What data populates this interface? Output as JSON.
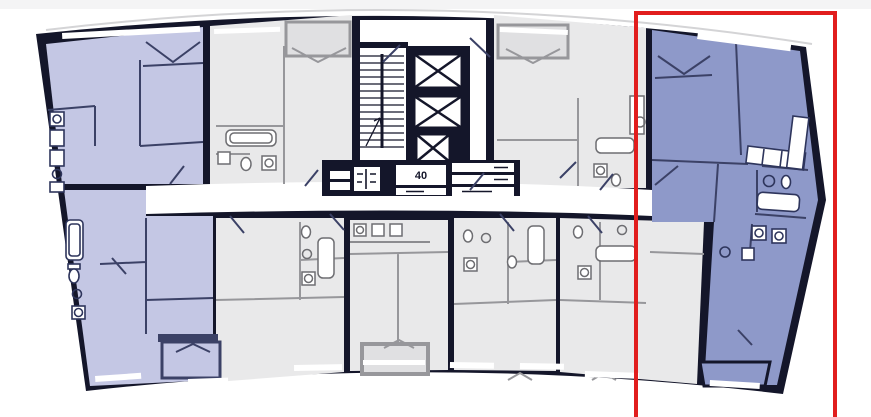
{
  "window": {
    "width": 871,
    "height": 417
  },
  "colors": {
    "background": "#ffffff",
    "top_band": "#f4f4f5",
    "wall": "#14162a",
    "apartment_lavender": "#c4c7e4",
    "apartment_periwinkle": "#8e99c9",
    "apartment_gray": "#e9e9ea",
    "loggia_gray": "#e0e0e2",
    "corridor_white": "#ffffff",
    "interior_wall_navy": "#3b4166",
    "interior_wall_gray": "#97979b",
    "fixture_navy": "#2e355c",
    "fixture_gray": "#6e6e72",
    "window_white": "#ffffff",
    "roofline_gray": "#d4d4d6",
    "highlight_red": "#e11d1d"
  },
  "plan": {
    "core_label": "40",
    "apartments": [
      {
        "key": "left-top",
        "tone": "lavender",
        "highlighted": false
      },
      {
        "key": "left-bottom",
        "tone": "lavender",
        "highlighted": false
      },
      {
        "key": "top-mid-left",
        "tone": "gray",
        "highlighted": false
      },
      {
        "key": "top-mid-right",
        "tone": "gray",
        "highlighted": false
      },
      {
        "key": "bottom-1",
        "tone": "gray",
        "highlighted": false
      },
      {
        "key": "bottom-2",
        "tone": "gray",
        "highlighted": false
      },
      {
        "key": "bottom-3",
        "tone": "gray",
        "highlighted": false
      },
      {
        "key": "bottom-4",
        "tone": "gray",
        "highlighted": false
      },
      {
        "key": "right-corner",
        "tone": "periwinkle",
        "highlighted": true
      }
    ],
    "core": {
      "elevators": 3,
      "stairs": true
    },
    "highlight_box": {
      "x": 636,
      "y": 13,
      "w": 199,
      "h": 415
    },
    "icons": {
      "elevator": "crossed-box",
      "stairs": "tread-lines",
      "balcony_door": "v-mark",
      "bathtub": "rounded-rect",
      "sink": "circle",
      "toilet": "ellipse-with-tank",
      "washer": "square-with-circle"
    }
  }
}
